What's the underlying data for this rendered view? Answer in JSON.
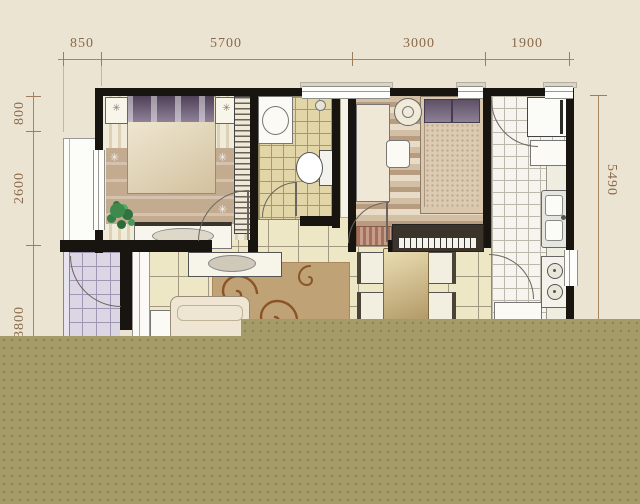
{
  "image_type": "apartment-floor-plan",
  "dims": {
    "top": [
      "850",
      "5700",
      "3000",
      "1900"
    ],
    "left": [
      "800",
      "2600",
      "3800"
    ],
    "right": [
      "5490"
    ]
  },
  "icons": {
    "rug_star_glyph": "✳",
    "lamp_star_glyph": "✳"
  },
  "colors": {
    "paper_background": "#ece4d3",
    "dimension_text": "#8a6a4a",
    "wall": "#181410",
    "censor_block": "#a49b69",
    "censor_dot": "#8b8254",
    "living_tile": "#eee7c6",
    "bath_tile": "#e2d6a8",
    "balcony_tile": "#dbd5e4"
  }
}
